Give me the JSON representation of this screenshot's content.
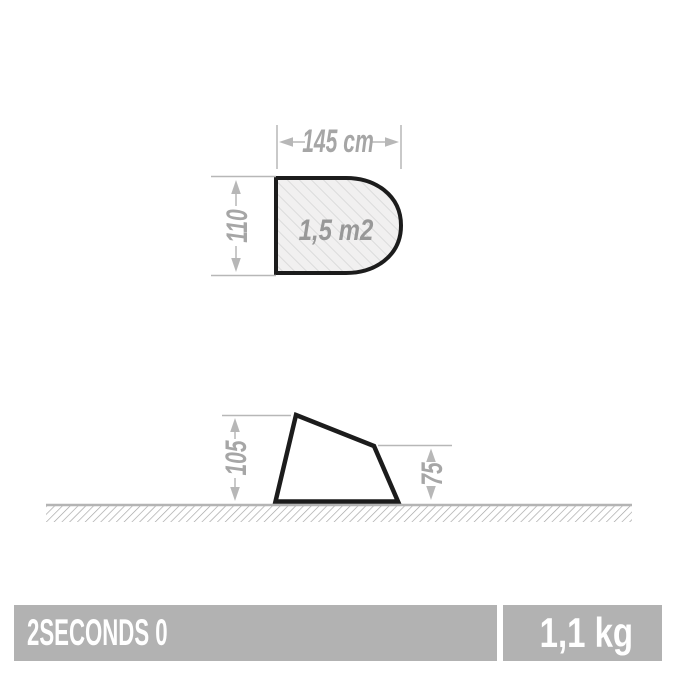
{
  "product": {
    "name": "2SECONDS 0",
    "weight": "1,1 kg"
  },
  "top_view": {
    "width_label": "145 cm",
    "depth_label": "110",
    "area_label": "1,5 m2"
  },
  "side_view": {
    "height_left_label": "105",
    "height_right_label": "75"
  },
  "colors": {
    "dimension_text": "#a6a6a6",
    "dimension_line": "#b7b7b7",
    "outline_stroke": "#1c1c1c",
    "hatch_fill_bg": "#f1f0f0",
    "hatch_fill_line": "#dbdbdb",
    "ground_line": "#b4b4b4",
    "ground_hatch_line": "#a2a2a2",
    "footer_bar_bg": "#b2b2b2",
    "footer_text": "#ffffff",
    "background": "#ffffff"
  }
}
